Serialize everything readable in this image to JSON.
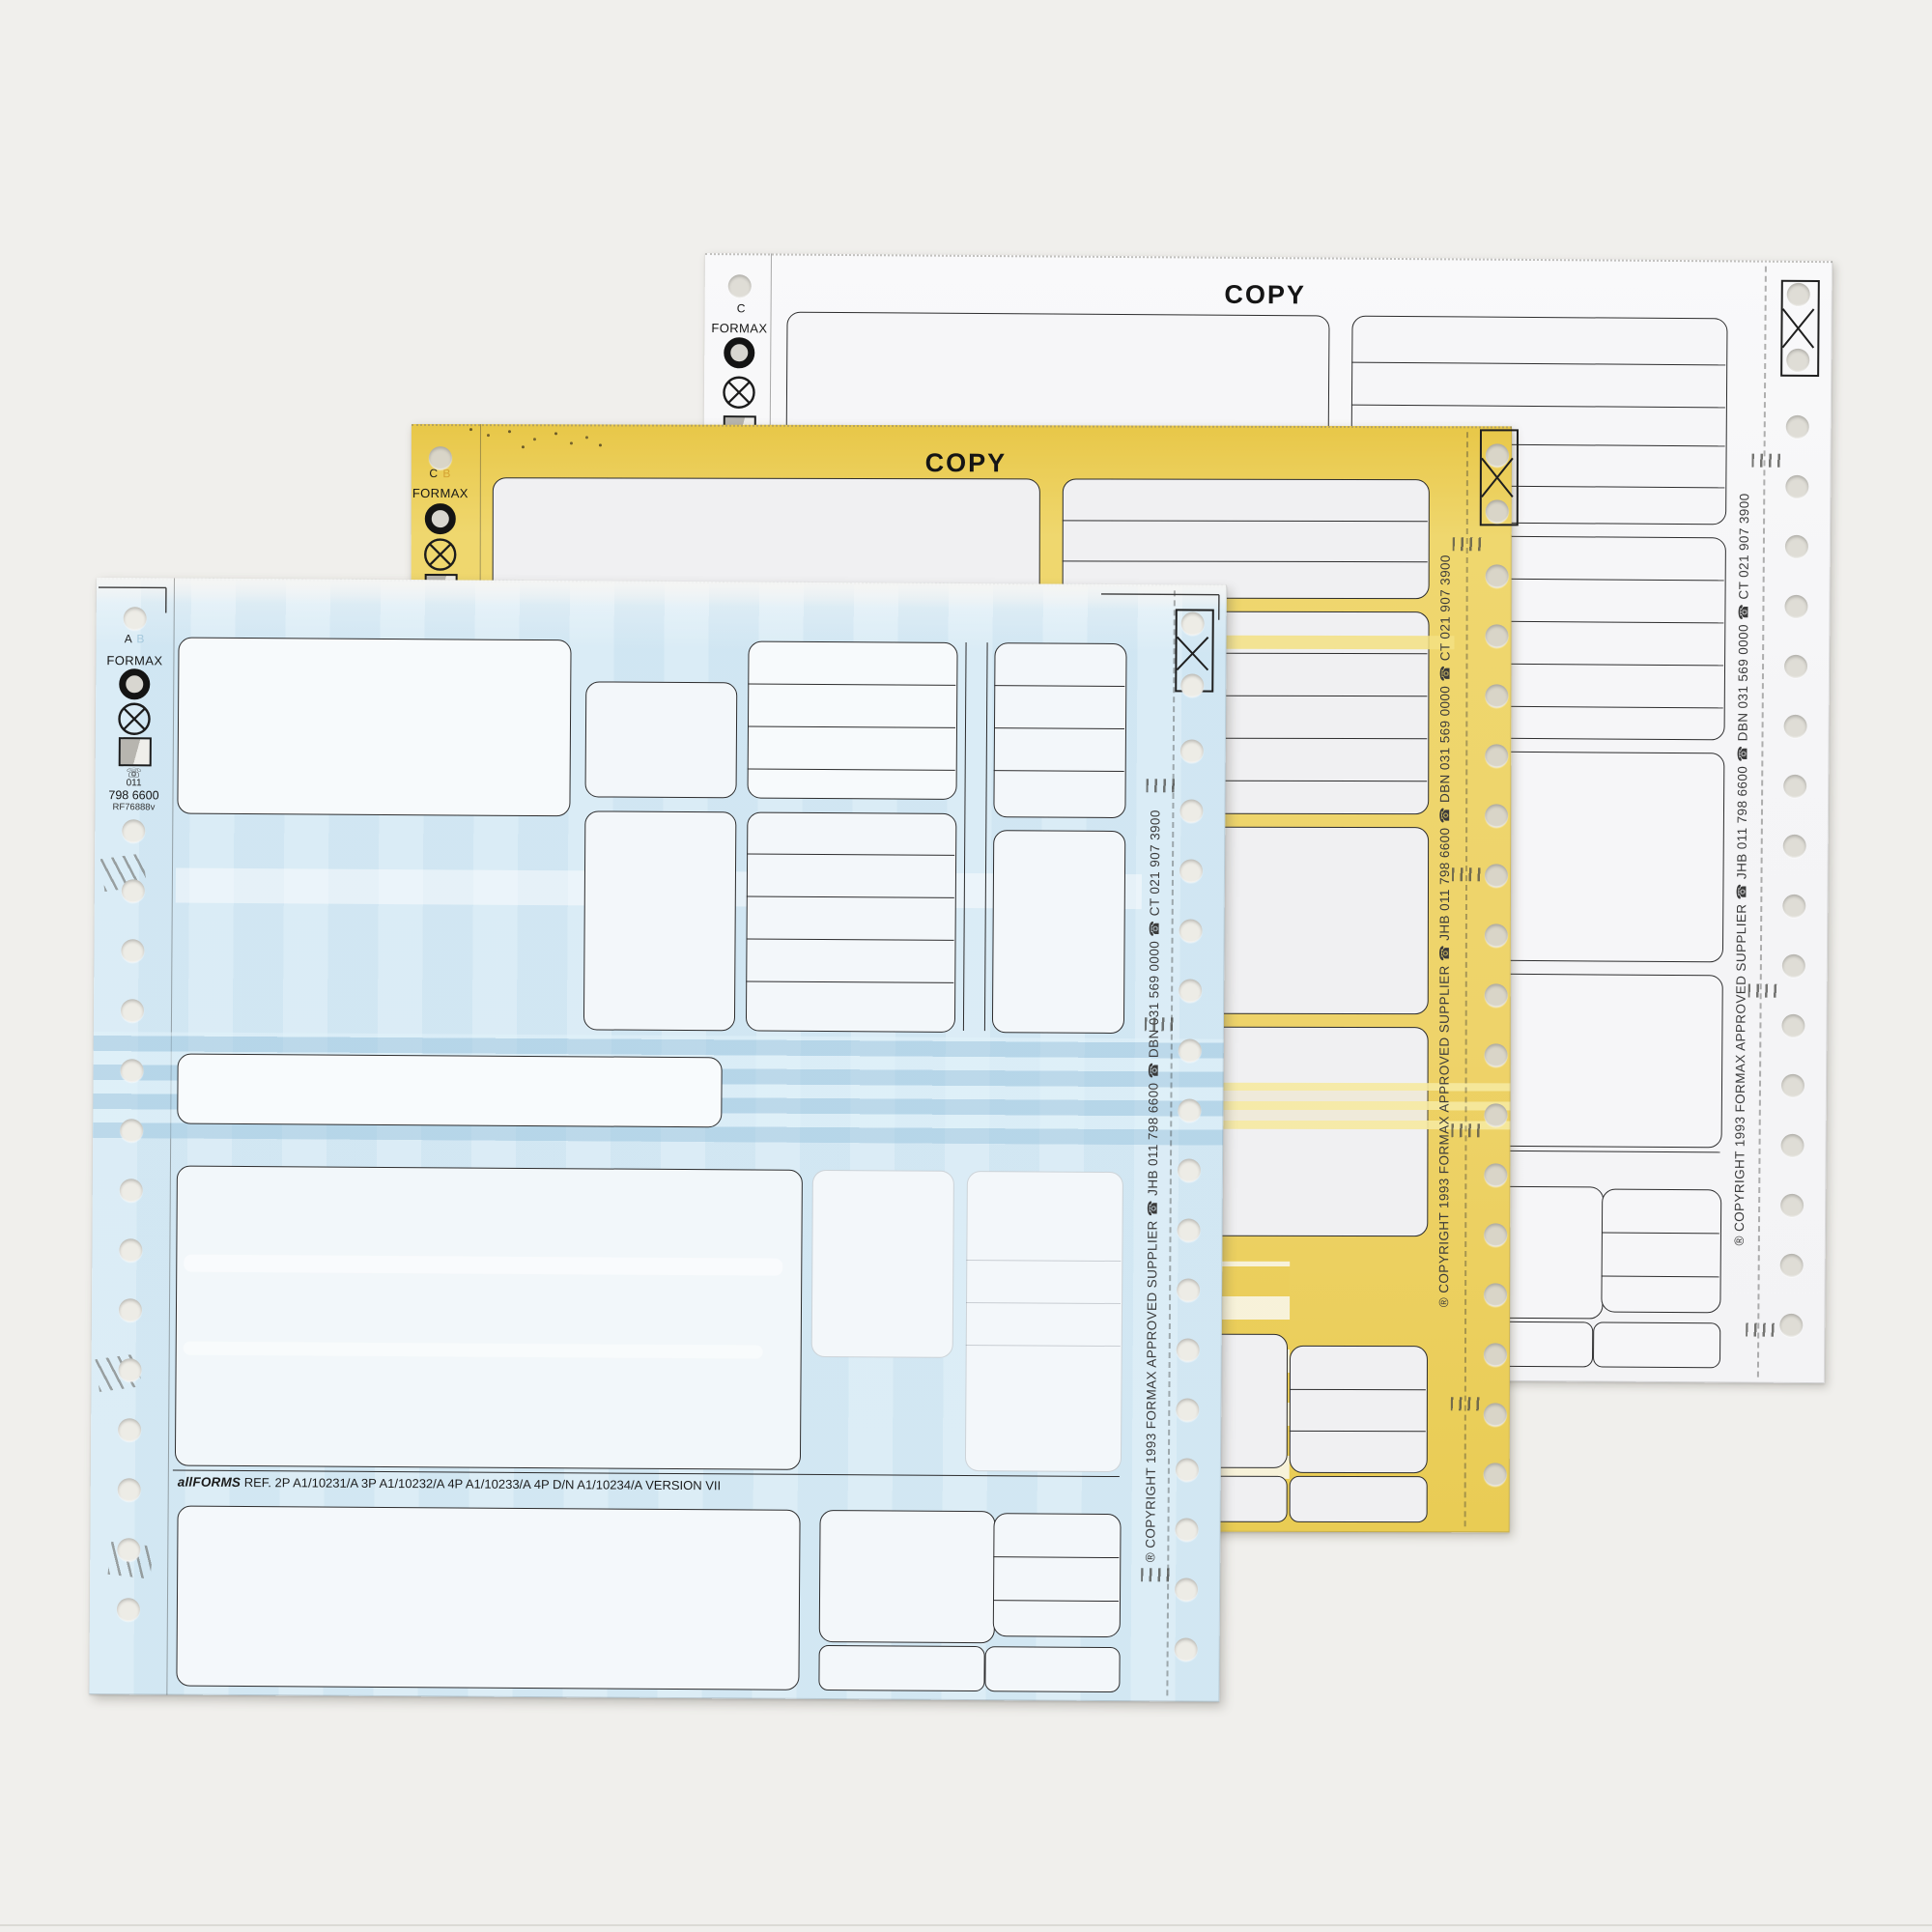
{
  "shared": {
    "brand": "FORMAX",
    "copy_watermark": "COPY",
    "vertical_copyright": "® COPYRIGHT  1993 FORMAX APPROVED SUPPLIER   ☎ JHB  011 798 6600   ☎ DBN 031 569 0000   ☎ CT 021 907 3900"
  },
  "white_sheet": {
    "part_letter": "C"
  },
  "yellow_sheet": {
    "part_letter": "C",
    "part_letter_ghost": "B"
  },
  "blue_sheet": {
    "part_letter": "A",
    "part_letter_ghost": "B",
    "margin_phone_icon": "☏",
    "margin_phone_code": "011",
    "margin_phone": "798 6600",
    "margin_ref": "RF76888v",
    "footer_brand": "allFORMS",
    "footer_text": "REF. 2P A1/10231/A  3P  A1/10232/A 4P A1/10233/A  4P  D/N A1/10234/A  VERSION VII"
  }
}
